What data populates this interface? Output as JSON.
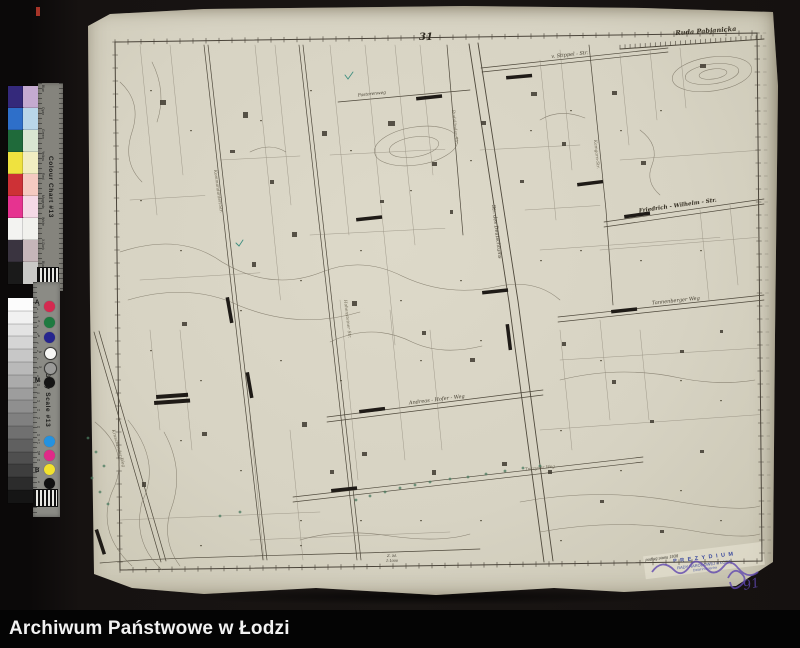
{
  "archive_bar": {
    "title": "Archiwum Państwowe w Łodzi"
  },
  "calibration": {
    "colour_chart": {
      "title": "Colour Chart #13",
      "rows": [
        {
          "name": "Blue",
          "color": "#34297b",
          "tint": "#c4aad0"
        },
        {
          "name": "Cyan",
          "color": "#2e6fc9",
          "tint": "#b9d6e9"
        },
        {
          "name": "Green",
          "color": "#1f6a3a",
          "tint": "#d9e5d1"
        },
        {
          "name": "Yellow",
          "color": "#efe23f",
          "tint": "#f1edc1"
        },
        {
          "name": "Red",
          "color": "#cd3136",
          "tint": "#f5cac1"
        },
        {
          "name": "Magenta",
          "color": "#e63390",
          "tint": "#f5d9e6"
        },
        {
          "name": "White",
          "color": "#f3f3f1",
          "tint": "#f1f1ed"
        },
        {
          "name": "X-Dark",
          "color": "#3a3440",
          "tint": "#c5b5b9"
        },
        {
          "name": "Black",
          "color": "#1a1a1a",
          "tint": "#c9c9c7"
        }
      ]
    },
    "grey_scale": {
      "title": "Grey Scale #13",
      "steps": [
        "#fcfcfc",
        "#f1f1f1",
        "#e3e3e3",
        "#d5d5d5",
        "#c7c7c7",
        "#b9b9b9",
        "#ababab",
        "#9d9d9d",
        "#8f8f8f",
        "#808080",
        "#707070",
        "#606060",
        "#4f4f4f",
        "#3e3e3e",
        "#2c2c2c",
        "#151515"
      ],
      "markers": [
        "A",
        "M",
        "B"
      ],
      "numbers": [
        "1",
        "2",
        "3",
        "4",
        "5",
        "6",
        "7",
        "8",
        "9",
        "10",
        "11",
        "12",
        "13",
        "14",
        "15",
        "16",
        "17",
        "18",
        "19"
      ],
      "dots_primary": [
        {
          "label": "R",
          "color": "#d42a50"
        },
        {
          "label": "G",
          "color": "#1e7a40"
        },
        {
          "label": "B",
          "color": "#26258e"
        },
        {
          "label": "W",
          "color": "#f6f6f4"
        },
        {
          "label": "Gr",
          "color": "#9a9a98"
        },
        {
          "label": "Bl",
          "color": "#141414"
        }
      ],
      "dots_process": [
        {
          "label": "C",
          "color": "#2492e0"
        },
        {
          "label": "M",
          "color": "#e02a88"
        },
        {
          "label": "Y",
          "color": "#f2e22e"
        },
        {
          "label": "K",
          "color": "#111111"
        }
      ]
    }
  },
  "map": {
    "sheet_number": "31",
    "scale_label": "Z. M.",
    "scale_value": "1:1000",
    "handwritten_number": "91",
    "stamp": {
      "lines": [
        "podług stanu 1938",
        "P R E Z Y D I U M",
        "RADY NARODOWEJ w ŁODZI",
        "Dział Pomiarów"
      ]
    },
    "street_labels": [
      {
        "text": "Ruda Pabjanicka",
        "x": 706,
        "y": 33,
        "size": 6.5,
        "rot": -4,
        "anchor": "middle",
        "cls": "lbl-major"
      },
      {
        "text": "v. Stippel - Str.",
        "x": 570,
        "y": 56,
        "size": 5,
        "rot": -6,
        "anchor": "middle",
        "cls": "lbl-minor"
      },
      {
        "text": "Pastorenweg",
        "x": 372,
        "y": 95,
        "size": 4.3,
        "rot": -6,
        "anchor": "middle",
        "cls": "lbl-minor"
      },
      {
        "text": "Friedrich - Wilhelm - Str.",
        "x": 678,
        "y": 207,
        "size": 5.6,
        "rot": -8,
        "anchor": "middle",
        "cls": "lbl-major"
      },
      {
        "text": "Tannenberger Weg",
        "x": 676,
        "y": 302,
        "size": 5,
        "rot": -6,
        "anchor": "middle",
        "cls": "lbl-minor"
      },
      {
        "text": "Andreas - Hofer - Weg",
        "x": 437,
        "y": 401,
        "size": 5,
        "rot": -7,
        "anchor": "middle",
        "cls": "lbl-minor"
      },
      {
        "text": "Tuczyner Weg",
        "x": 540,
        "y": 469,
        "size": 4.2,
        "rot": -6,
        "anchor": "middle",
        "cls": "lbl-faint"
      },
      {
        "text": "Str. des Deutschtums",
        "x": 492,
        "y": 205,
        "size": 5,
        "rot": 83,
        "anchor": "start",
        "cls": "lbl-minor"
      },
      {
        "text": "Rudaländer Str.",
        "x": 452,
        "y": 110,
        "size": 4.3,
        "rot": 84,
        "anchor": "start",
        "cls": "lbl-faint"
      },
      {
        "text": "Kommandanten-Str.",
        "x": 214,
        "y": 170,
        "size": 4.3,
        "rot": 82,
        "anchor": "start",
        "cls": "lbl-faint"
      },
      {
        "text": "Kamgarn-Str.",
        "x": 594,
        "y": 140,
        "size": 4.3,
        "rot": 84,
        "anchor": "start",
        "cls": "lbl-faint"
      },
      {
        "text": "Hohensteiner Str.",
        "x": 344,
        "y": 300,
        "size": 4.3,
        "rot": 83,
        "anchor": "start",
        "cls": "lbl-faint"
      },
      {
        "text": "Kruschender Weg",
        "x": 112,
        "y": 430,
        "size": 4.3,
        "rot": 74,
        "anchor": "start",
        "cls": "lbl-faint"
      }
    ]
  }
}
